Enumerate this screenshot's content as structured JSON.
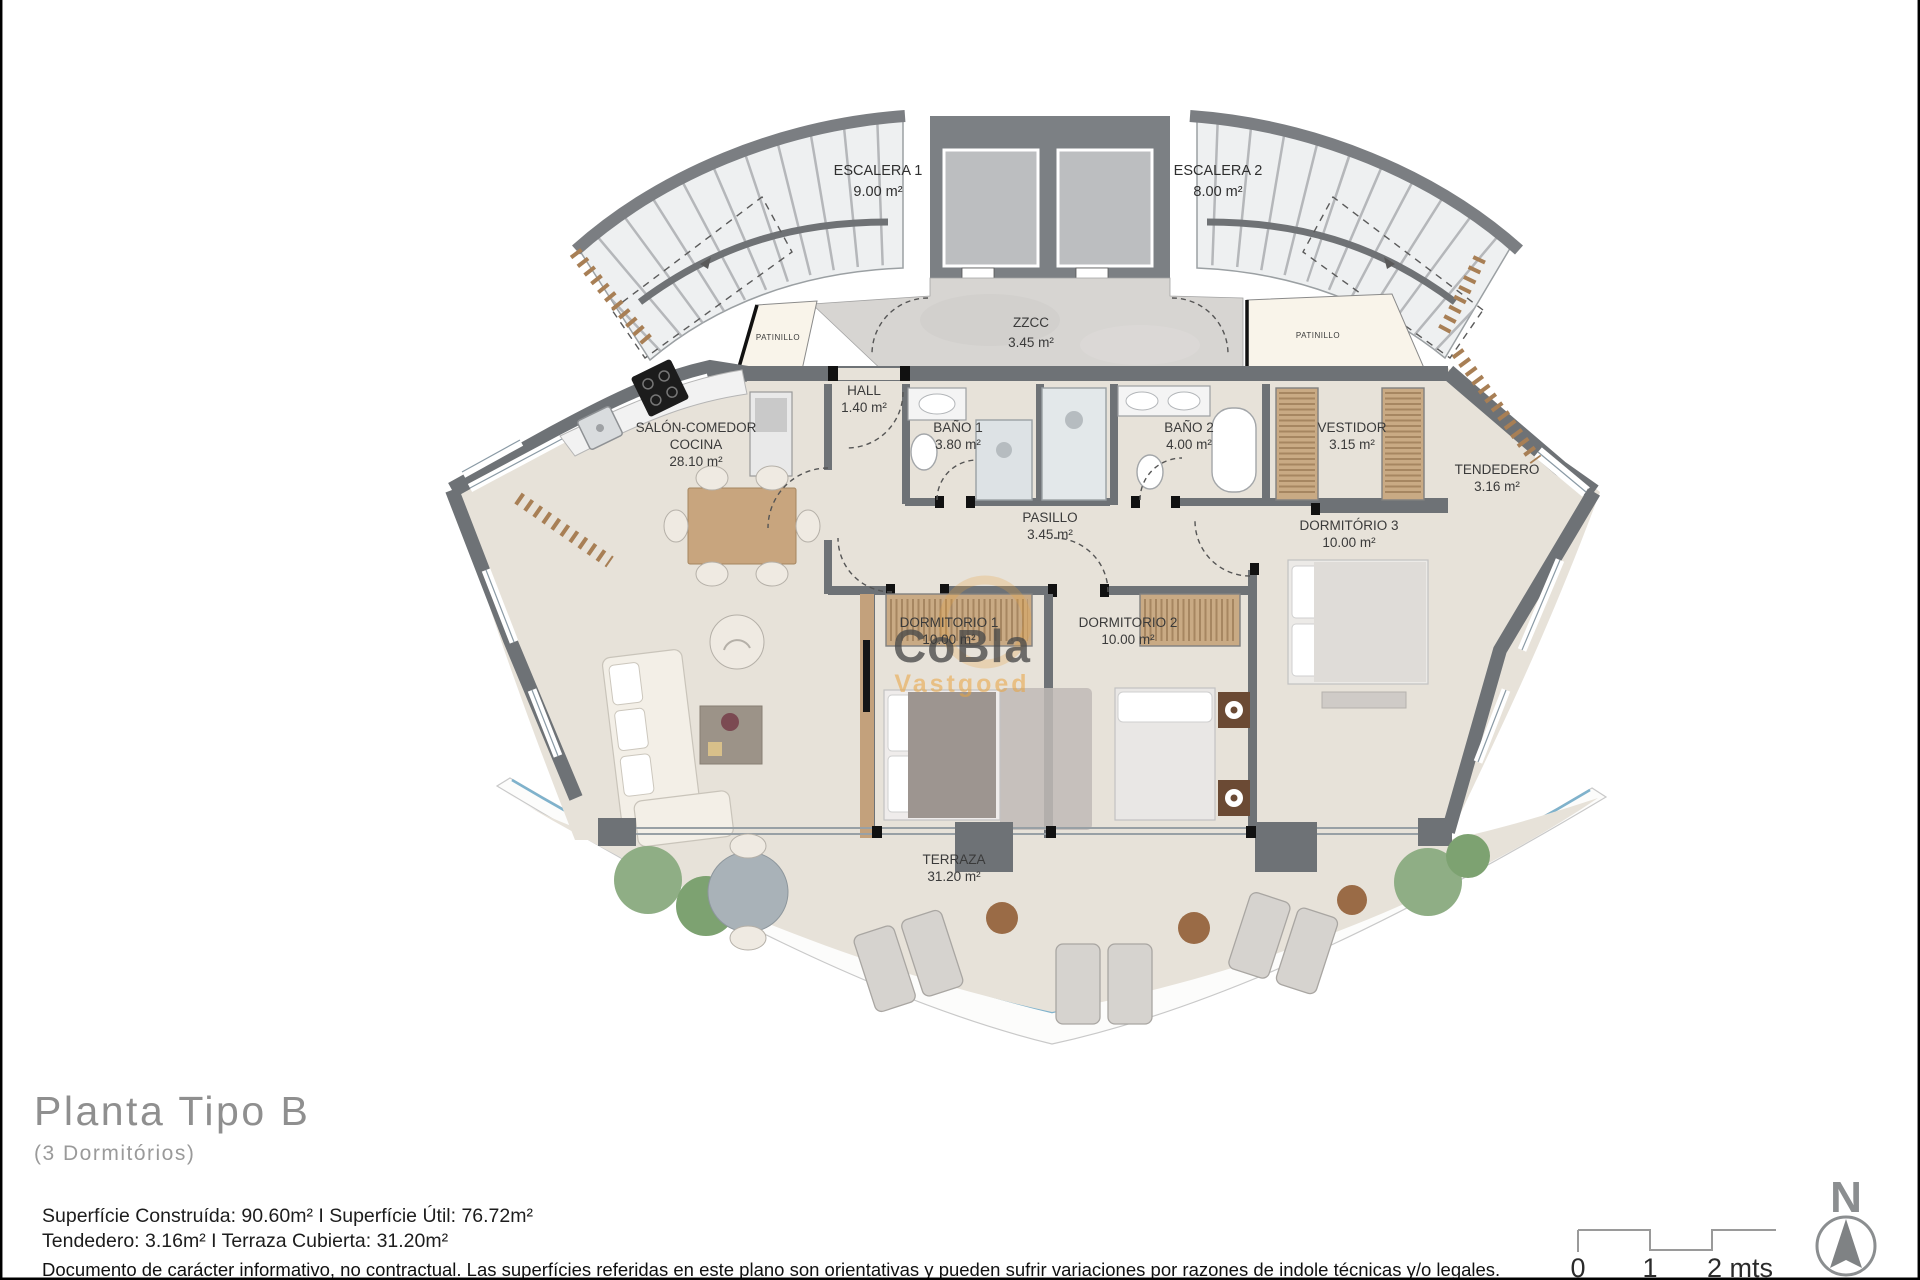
{
  "document": {
    "type": "architectural-floor-plan",
    "title": "Planta Tipo B",
    "subtitle": "(3 Dormitórios)",
    "areas_line1": "Superfície Construída: 90.60m² I Superfície Útil: 76.72m²",
    "areas_line2": "Tendedero: 3.16m² I Terraza Cubierta: 31.20m²",
    "disclaimer": "Documento de carácter informativo, no contractual. Las superfícies referidas en este plano son orientativas y pueden sufrir variaciones por razones de indole técnicas y/o legales."
  },
  "rooms": {
    "escalera1": {
      "name": "ESCALERA 1",
      "area": "9.00 m²"
    },
    "escalera2": {
      "name": "ESCALERA 2",
      "area": "8.00 m²"
    },
    "zzcc": {
      "name": "ZZCC",
      "area": "3.45 m²"
    },
    "patinillo_left": {
      "name": "PATINILLO"
    },
    "patinillo_right": {
      "name": "PATINILLO"
    },
    "hall": {
      "name": "HALL",
      "area": "1.40 m²"
    },
    "salon": {
      "line1": "SALÓN-COMEDOR",
      "line2": "COCINA",
      "area": "28.10 m²"
    },
    "bano1": {
      "name": "BAÑO 1",
      "area": "3.80 m²"
    },
    "bano2": {
      "name": "BAÑO 2",
      "area": "4.00 m²"
    },
    "vestidor": {
      "name": "VESTIDOR",
      "area": "3.15 m²"
    },
    "tendedero": {
      "name": "TENDEDERO",
      "area": "3.16 m²"
    },
    "pasillo": {
      "name": "PASILLO",
      "area": "3.45 m²"
    },
    "dormitorio1": {
      "name": "DORMITORIO 1",
      "area": "10.00 m²"
    },
    "dormitorio2": {
      "name": "DORMITORIO 2",
      "area": "10.00 m²"
    },
    "dormitorio3": {
      "name": "DORMITÓRIO 3",
      "area": "10.00 m²"
    },
    "terraza": {
      "name": "TERRAZA",
      "area": "31.20 m²"
    }
  },
  "watermark": {
    "line1": "CoBla",
    "line2": "Vastgoed"
  },
  "scale_bar": {
    "labels": [
      "0",
      "1",
      "2 mts"
    ]
  },
  "compass": {
    "label": "N"
  },
  "colors": {
    "wall": "#6e7276",
    "floor": "#e7e2d9",
    "stair_fill": "#eef0f1",
    "common_zone": "#d7d5d2",
    "patinillo": "#f9f4ea",
    "wood": "#c9aa84",
    "hatch_brick": "#a87f55",
    "glass_blue": "#7fb2cc",
    "accent_orange": "#e9a43f",
    "border": "#000000"
  }
}
